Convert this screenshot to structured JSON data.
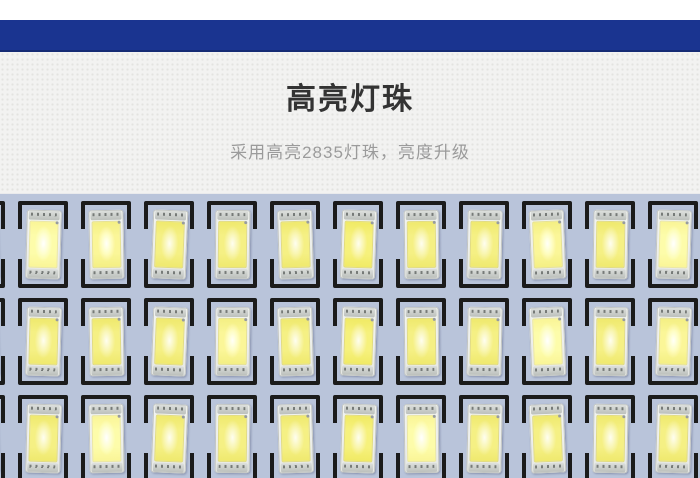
{
  "colors": {
    "banner": "#1a3490",
    "banner-edge": "#142a73",
    "section-bg": "#f2f2f1",
    "section-dot": "#e3e3e0",
    "title": "#333333",
    "subtitle": "#9b9b9b",
    "pcb": "#b9c4da",
    "silk": "#1b1b1b",
    "led-body": "#edefec",
    "led-edge": "#c2c5c2",
    "electrode": "#c8ccc8",
    "phosphor": "#f5f084",
    "phosphor-deep": "#efe96e"
  },
  "header": {
    "title": "高亮灯珠",
    "subtitle": "采用高亮2835灯珠，亮度升级"
  },
  "photo": {
    "subject": "led-pcb-closeup",
    "grid": {
      "rows": 3,
      "columns": 12,
      "col_start": -1,
      "x_center0": 43,
      "pitch": 63,
      "box_w": 50,
      "box_h": 87,
      "row_tops": [
        7,
        104,
        201
      ],
      "tilts": [
        -2,
        1.5,
        -1,
        2.2,
        0.6,
        -1.6,
        1.8,
        -0.6,
        1.2,
        -2.2,
        0.9,
        1.6
      ]
    }
  }
}
